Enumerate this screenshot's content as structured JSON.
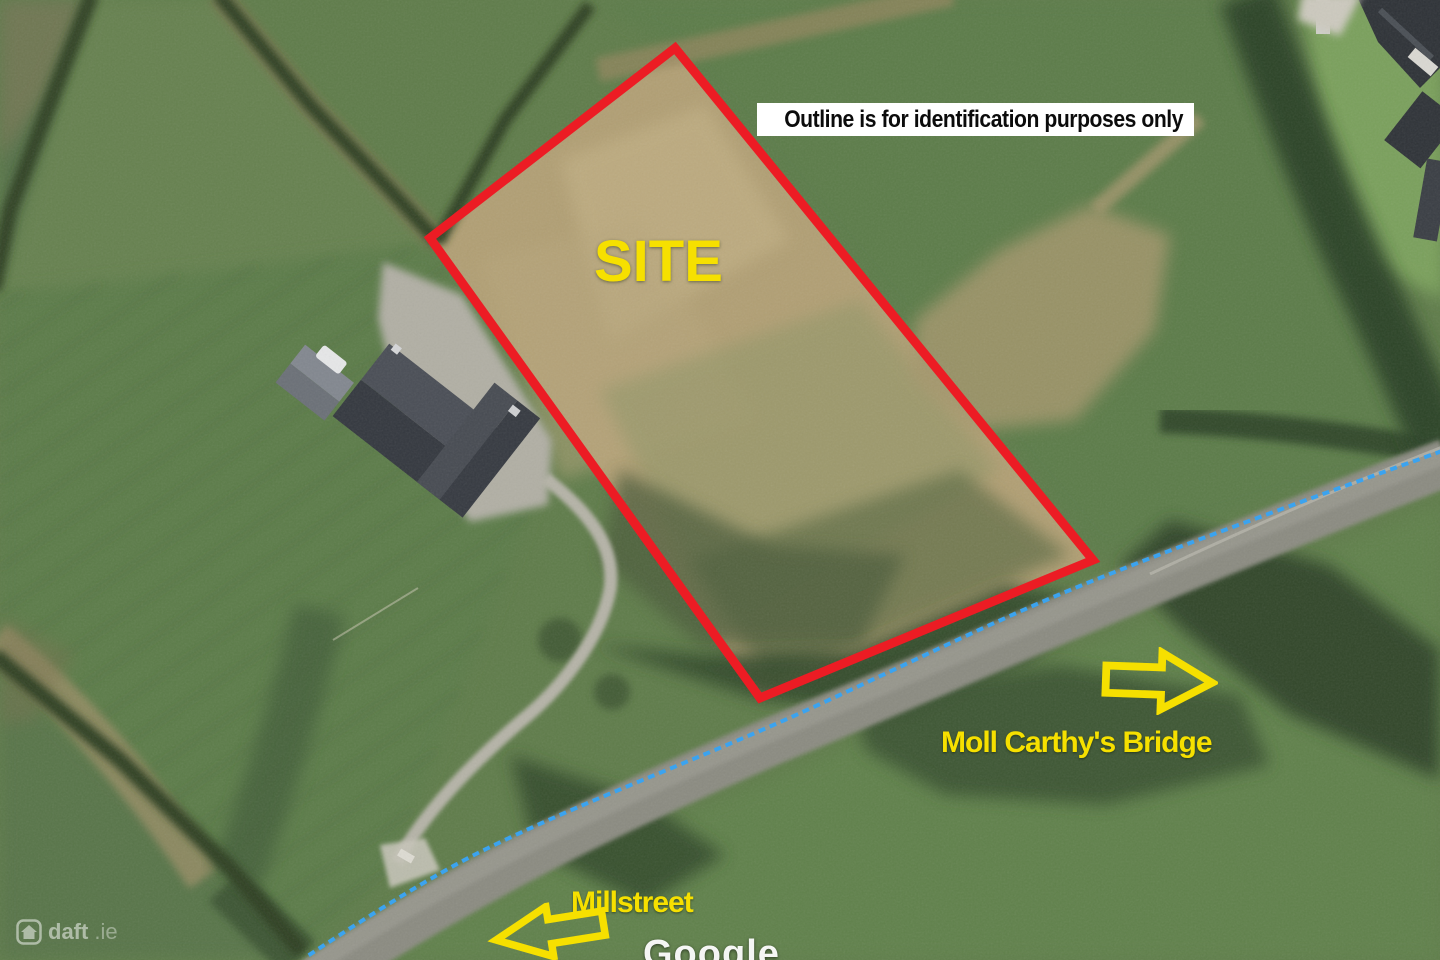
{
  "annotations": {
    "disclaimer": "Outline is for identification purposes only",
    "site_label": "SITE",
    "bridge_label": "Moll Carthy's Bridge",
    "town_label": "Millstreet"
  },
  "imagery": {
    "partial_imagery_label": "Google",
    "watermark_brand": "daft",
    "watermark_tld": ".ie"
  },
  "colors": {
    "outline_red": "#EC1C24",
    "annotation_yellow": "#F6E000",
    "route_blue": "#3BA3EF",
    "disclaimer_bg": "#FFFFFF",
    "disclaimer_text": "#0B0B0B"
  }
}
